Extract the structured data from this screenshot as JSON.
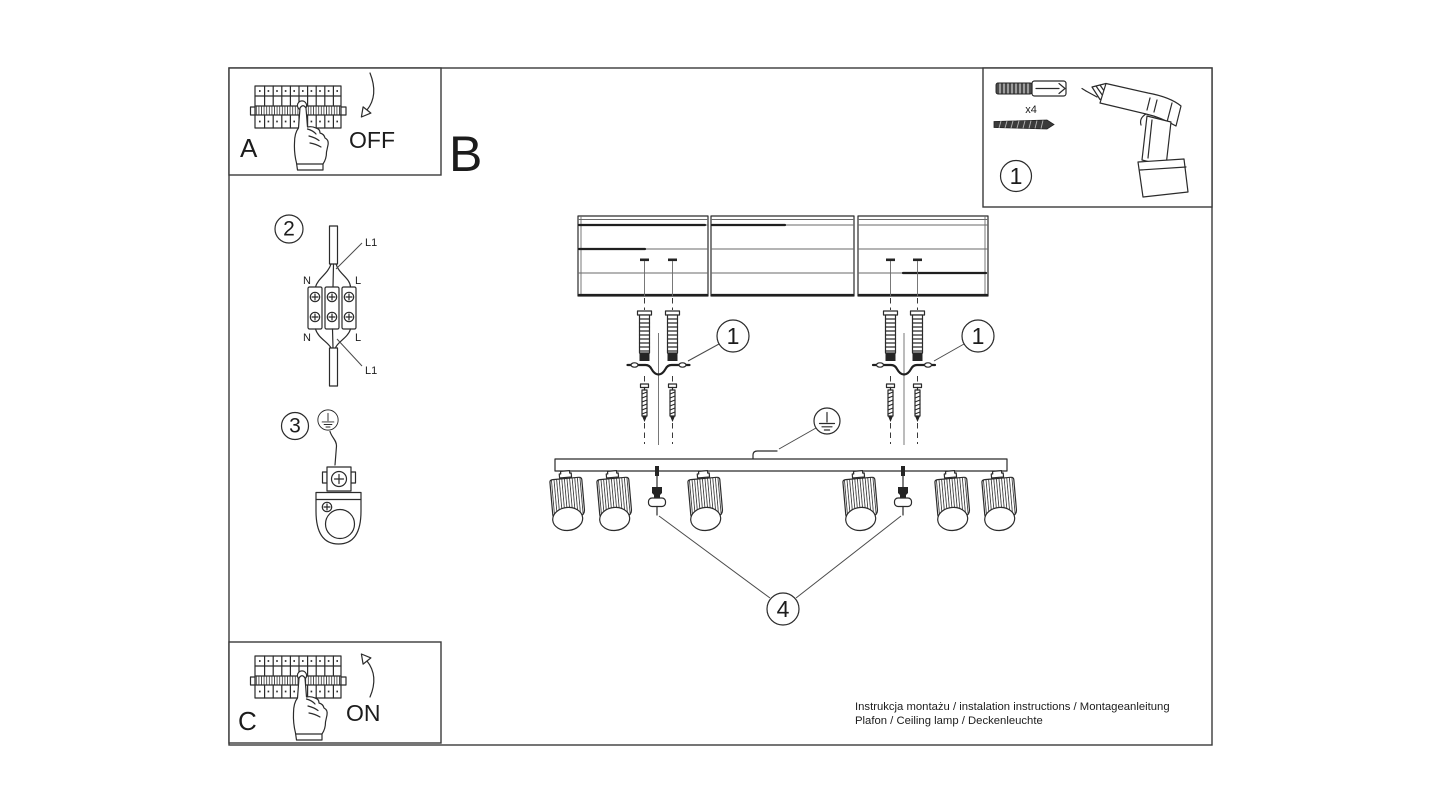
{
  "colors": {
    "ink": "#2b2b2b",
    "paper": "#ffffff"
  },
  "steps": {
    "a": {
      "label": "A",
      "state": "OFF"
    },
    "b": {
      "label": "B"
    },
    "c": {
      "label": "C",
      "state": "ON"
    }
  },
  "parts": {
    "anchors": {
      "number": "1",
      "qty": "x4"
    },
    "callout_left": "1",
    "callout_right": "1",
    "wiring": {
      "number": "2",
      "labels": {
        "l1_top": "L1",
        "n_top": "N",
        "l_top": "L",
        "n_bottom": "N",
        "l_bottom": "L",
        "l1_bottom": "L1"
      }
    },
    "ground": {
      "number": "3"
    },
    "cover_screw": {
      "number": "4"
    }
  },
  "footer": {
    "line1": "Instrukcja montażu / instalation instructions / Montageanleitung",
    "line2": "Plafon / Ceiling lamp / Deckenleuchte"
  }
}
